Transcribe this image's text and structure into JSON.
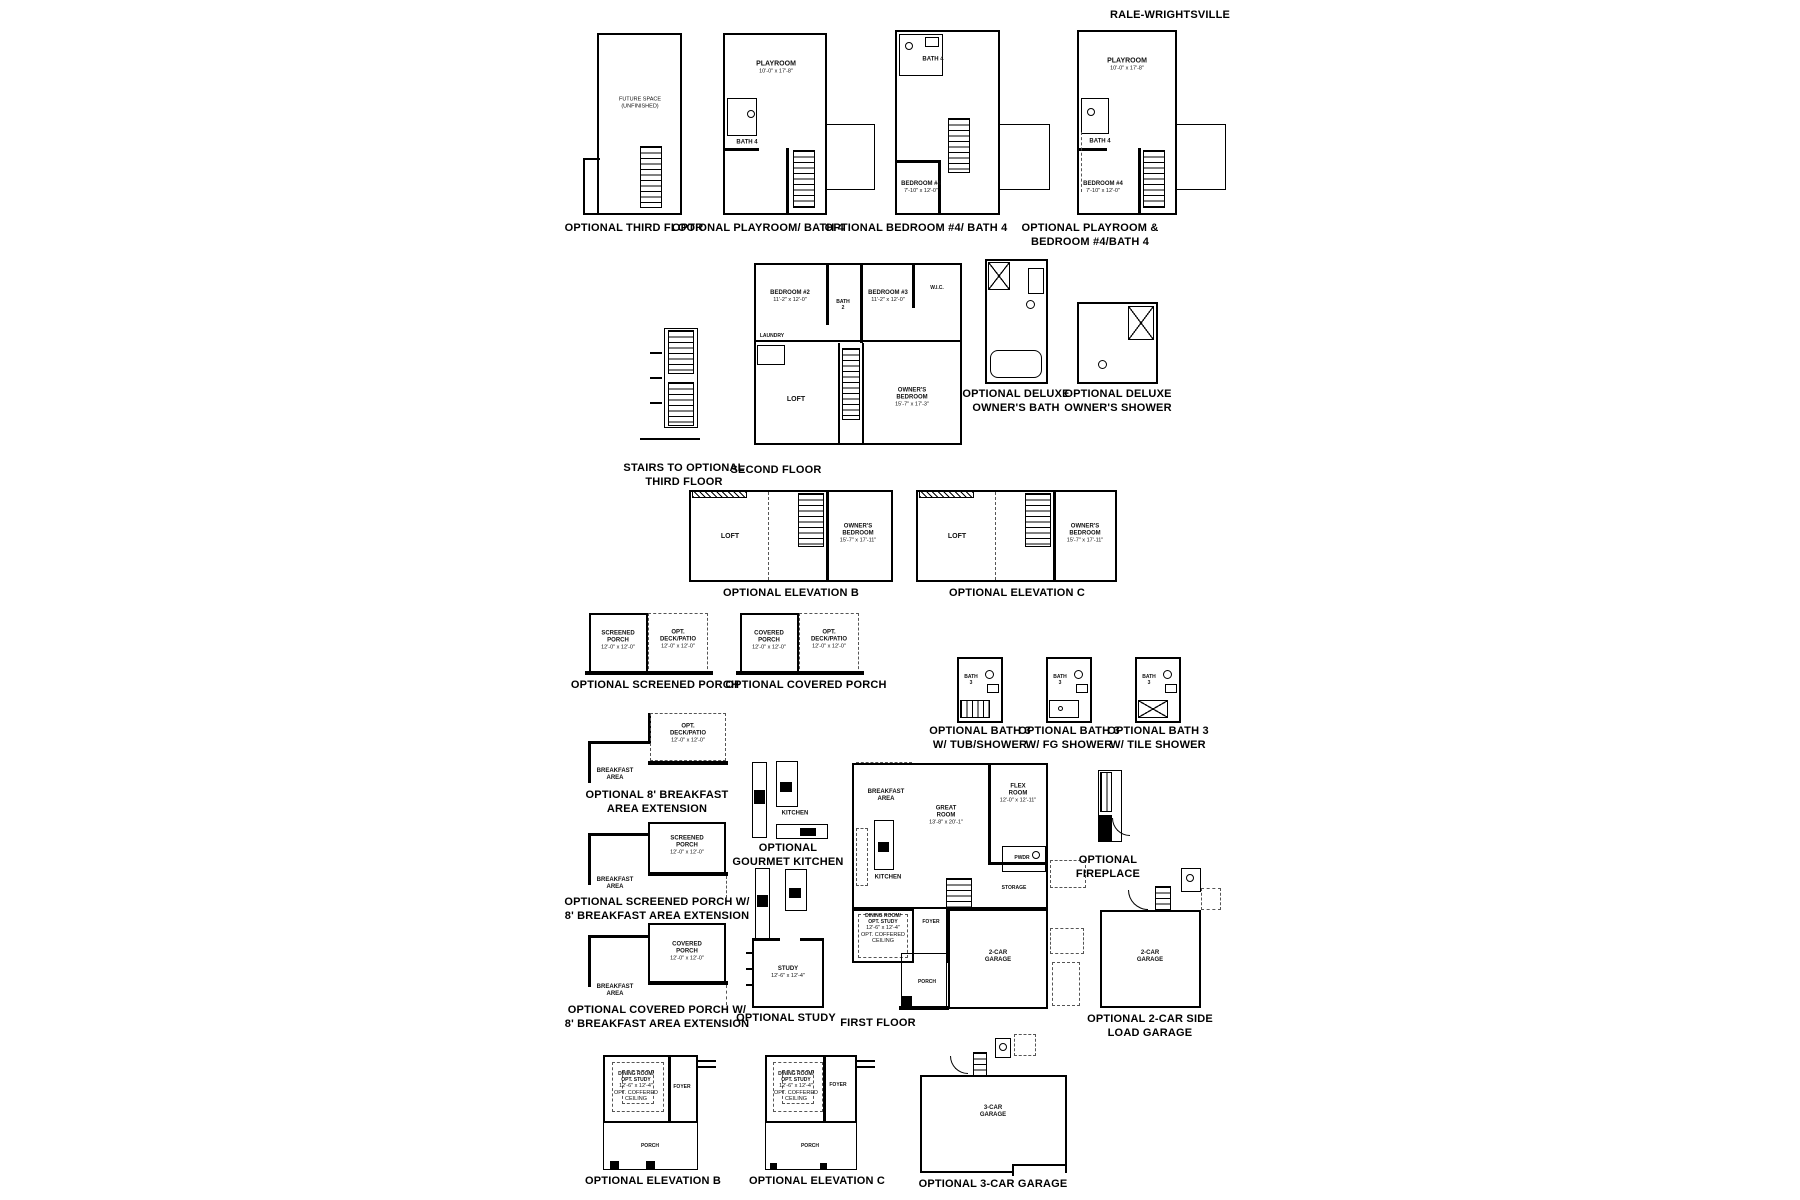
{
  "title": "RALE-WRIGHTSVILLE",
  "panels": {
    "third_floor": {
      "caption": "OPTIONAL THIRD FLOOR",
      "space": "FUTURE SPACE\n(UNFINISHED)"
    },
    "playroom_bath4": {
      "caption": "OPTIONAL PLAYROOM/ BATH 4",
      "playroom": "PLAYROOM",
      "playroom_dim": "10'-0\" x 17'-8\"",
      "bath4": "BATH 4"
    },
    "bedroom4_bath4": {
      "caption": "OPTIONAL BEDROOM #4/ BATH 4",
      "bedroom4": "BEDROOM #4",
      "bedroom4_dim": "7'-10\" x 12'-0\"",
      "bath4": "BATH 4"
    },
    "playroom_bedroom4": {
      "caption": "OPTIONAL PLAYROOM &\nBEDROOM #4/BATH 4",
      "playroom": "PLAYROOM",
      "playroom_dim": "10'-0\" x 17'-8\"",
      "bedroom4": "BEDROOM #4",
      "bedroom4_dim": "7'-10\" x 12'-0\"",
      "bath4": "BATH 4"
    },
    "stairs_third": {
      "caption": "STAIRS TO OPTIONAL\nTHIRD FLOOR"
    },
    "second_floor": {
      "caption": "SECOND FLOOR",
      "bedroom2": "BEDROOM #2",
      "bedroom2_dim": "11'-2\" x 12'-0\"",
      "bedroom3": "BEDROOM #3",
      "bedroom3_dim": "11'-2\" x 12'-0\"",
      "bath2": "BATH\n2",
      "laundry": "LAUNDRY",
      "wic": "W.I.C.",
      "loft": "LOFT",
      "owners": "OWNER'S\nBEDROOM",
      "owners_dim": "15'-7\" x 17'-3\""
    },
    "deluxe_bath": {
      "caption": "OPTIONAL DELUXE\nOWNER'S BATH"
    },
    "deluxe_shower": {
      "caption": "OPTIONAL DELUXE\nOWNER'S SHOWER"
    },
    "elev_b2": {
      "caption": "OPTIONAL ELEVATION B",
      "loft": "LOFT",
      "owners": "OWNER'S\nBEDROOM",
      "owners_dim": "15'-7\" x 17'-11\""
    },
    "elev_c2": {
      "caption": "OPTIONAL ELEVATION C",
      "loft": "LOFT",
      "owners": "OWNER'S\nBEDROOM",
      "owners_dim": "15'-7\" x 17'-11\""
    },
    "screened_porch": {
      "caption": "OPTIONAL SCREENED PORCH",
      "porch": "SCREENED\nPORCH",
      "porch_dim": "12'-0\" x 12'-0\"",
      "deck": "OPT.\nDECK/PATIO",
      "deck_dim": "12'-0\" x 12'-0\""
    },
    "covered_porch": {
      "caption": "OPTIONAL COVERED PORCH",
      "porch": "COVERED\nPORCH",
      "porch_dim": "12'-0\" x 12'-0\"",
      "deck": "OPT.\nDECK/PATIO",
      "deck_dim": "12'-0\" x 12'-0\""
    },
    "bath3_tub": {
      "caption": "OPTIONAL BATH 3\nW/ TUB/SHOWER",
      "bath3": "BATH\n3"
    },
    "bath3_fg": {
      "caption": "OPTIONAL BATH 3\nW/ FG SHOWER",
      "bath3": "BATH\n3"
    },
    "bath3_tile": {
      "caption": "OPTIONAL BATH 3\nW/ TILE SHOWER",
      "bath3": "BATH\n3"
    },
    "breakfast_ext": {
      "caption": "OPTIONAL 8' BREAKFAST\nAREA EXTENSION",
      "breakfast": "BREAKFAST\nAREA",
      "deck": "OPT.\nDECK/PATIO",
      "deck_dim": "12'-0\" x 12'-0\""
    },
    "screened_ext": {
      "caption": "OPTIONAL SCREENED PORCH W/\n8' BREAKFAST AREA EXTENSION",
      "breakfast": "BREAKFAST\nAREA",
      "porch": "SCREENED\nPORCH",
      "porch_dim": "12'-0\" x 12'-0\""
    },
    "covered_ext": {
      "caption": "OPTIONAL COVERED PORCH W/\n8' BREAKFAST AREA EXTENSION",
      "breakfast": "BREAKFAST\nAREA",
      "porch": "COVERED\nPORCH",
      "porch_dim": "12'-0\" x 12'-0\""
    },
    "gourmet": {
      "caption": "OPTIONAL\nGOURMET KITCHEN",
      "kitchen": "KITCHEN"
    },
    "study": {
      "caption": "OPTIONAL STUDY",
      "study": "STUDY",
      "study_dim": "12'-6\" x 12'-4\""
    },
    "first_floor": {
      "caption": "FIRST FLOOR",
      "breakfast": "BREAKFAST\nAREA",
      "great": "GREAT\nROOM",
      "great_dim": "13'-8\" x 20'-1\"",
      "flex": "FLEX\nROOM",
      "flex_dim": "12'-0\" x 12'-11\"",
      "kitchen": "KITCHEN",
      "pwdr": "PWDR",
      "storage": "STORAGE",
      "dining": "DINING ROOM/\nOPT. STUDY",
      "dining_dim": "12'-6\" x 12'-4\"",
      "dining_note": "OPT. COFFERED\nCEILING",
      "foyer": "FOYER",
      "porch": "PORCH",
      "garage": "2-CAR\nGARAGE"
    },
    "fireplace": {
      "caption": "OPTIONAL\nFIREPLACE"
    },
    "side_garage": {
      "caption": "OPTIONAL 2-CAR SIDE\nLOAD GARAGE",
      "garage": "2-CAR\nGARAGE"
    },
    "elev_b1": {
      "caption": "OPTIONAL ELEVATION B",
      "dining": "DINING ROOM/\nOPT. STUDY",
      "dining_dim": "12'-6\" x 12'-4\"",
      "dining_note": "OPT. COFFERED\nCEILING",
      "foyer": "FOYER",
      "porch": "PORCH"
    },
    "elev_c1": {
      "caption": "OPTIONAL ELEVATION C",
      "dining": "DINING ROOM/\nOPT. STUDY",
      "dining_dim": "12'-6\" x 12'-4\"",
      "dining_note": "OPT. COFFERED\nCEILING",
      "foyer": "FOYER",
      "porch": "PORCH"
    },
    "garage3": {
      "caption": "OPTIONAL 3-CAR GARAGE",
      "garage": "3-CAR\nGARAGE"
    }
  }
}
